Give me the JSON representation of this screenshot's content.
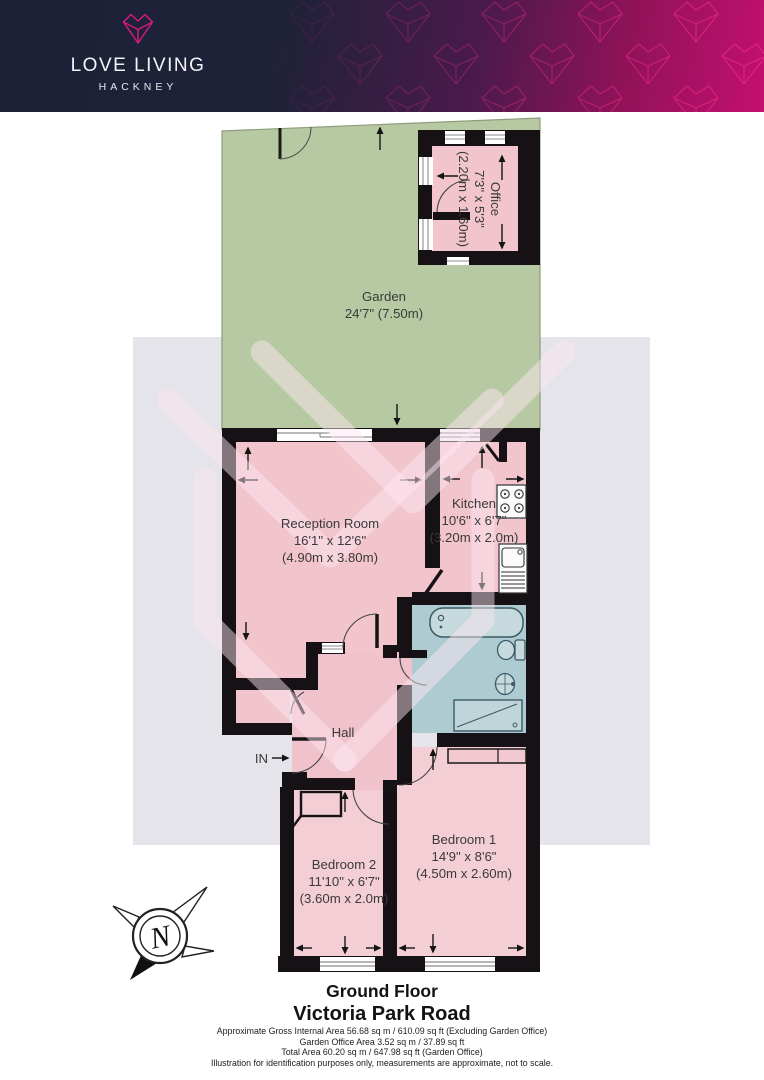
{
  "header": {
    "brand": "LOVE LIVING",
    "sub": "HACKNEY"
  },
  "plan": {
    "garden": {
      "name": "Garden",
      "size": "24'7\" (7.50m)"
    },
    "office": {
      "name": "Office",
      "size_imperial": "7'3\" x 5'3\"",
      "size_metric": "(2.20m x 1.60m)"
    },
    "reception": {
      "name": "Reception Room",
      "size_imperial": "16'1\" x 12'6\"",
      "size_metric": "(4.90m x 3.80m)"
    },
    "kitchen": {
      "name": "Kitchen",
      "size_imperial": "10'6\" x 6'7\"",
      "size_metric": "(3.20m x 2.0m)"
    },
    "hall": {
      "name": "Hall"
    },
    "bedroom1": {
      "name": "Bedroom 1",
      "size_imperial": "14'9\" x 8'6\"",
      "size_metric": "(4.50m x 2.60m)"
    },
    "bedroom2": {
      "name": "Bedroom 2",
      "size_imperial": "11'10\" x 6'7\"",
      "size_metric": "(3.60m x 2.0m)"
    },
    "entrance_label": "IN",
    "compass_label": "N"
  },
  "footer": {
    "floor": "Ground Floor",
    "address": "Victoria Park Road",
    "area_line1": "Approximate Gross Internal Area 56.68 sq m / 610.09 sq ft (Excluding Garden Office)",
    "area_line2": "Garden Office Area 3.52 sq m / 37.89 sq ft",
    "area_line3": "Total Area 60.20 sq m / 647.98 sq ft (Garden Office)",
    "disclaimer": "Illustration for identification purposes only, measurements are approximate, not to scale."
  },
  "colors": {
    "brand_navy": "#1d2138",
    "brand_magenta": "#c41070",
    "wall_black": "#151115",
    "room_pink": "#f2c5cd",
    "bedroom_pink": "#f4ced5",
    "bath_blue": "#aecbd2",
    "garden_green": "#b6c9a3",
    "watermark_gray": "#e4e4ea"
  }
}
